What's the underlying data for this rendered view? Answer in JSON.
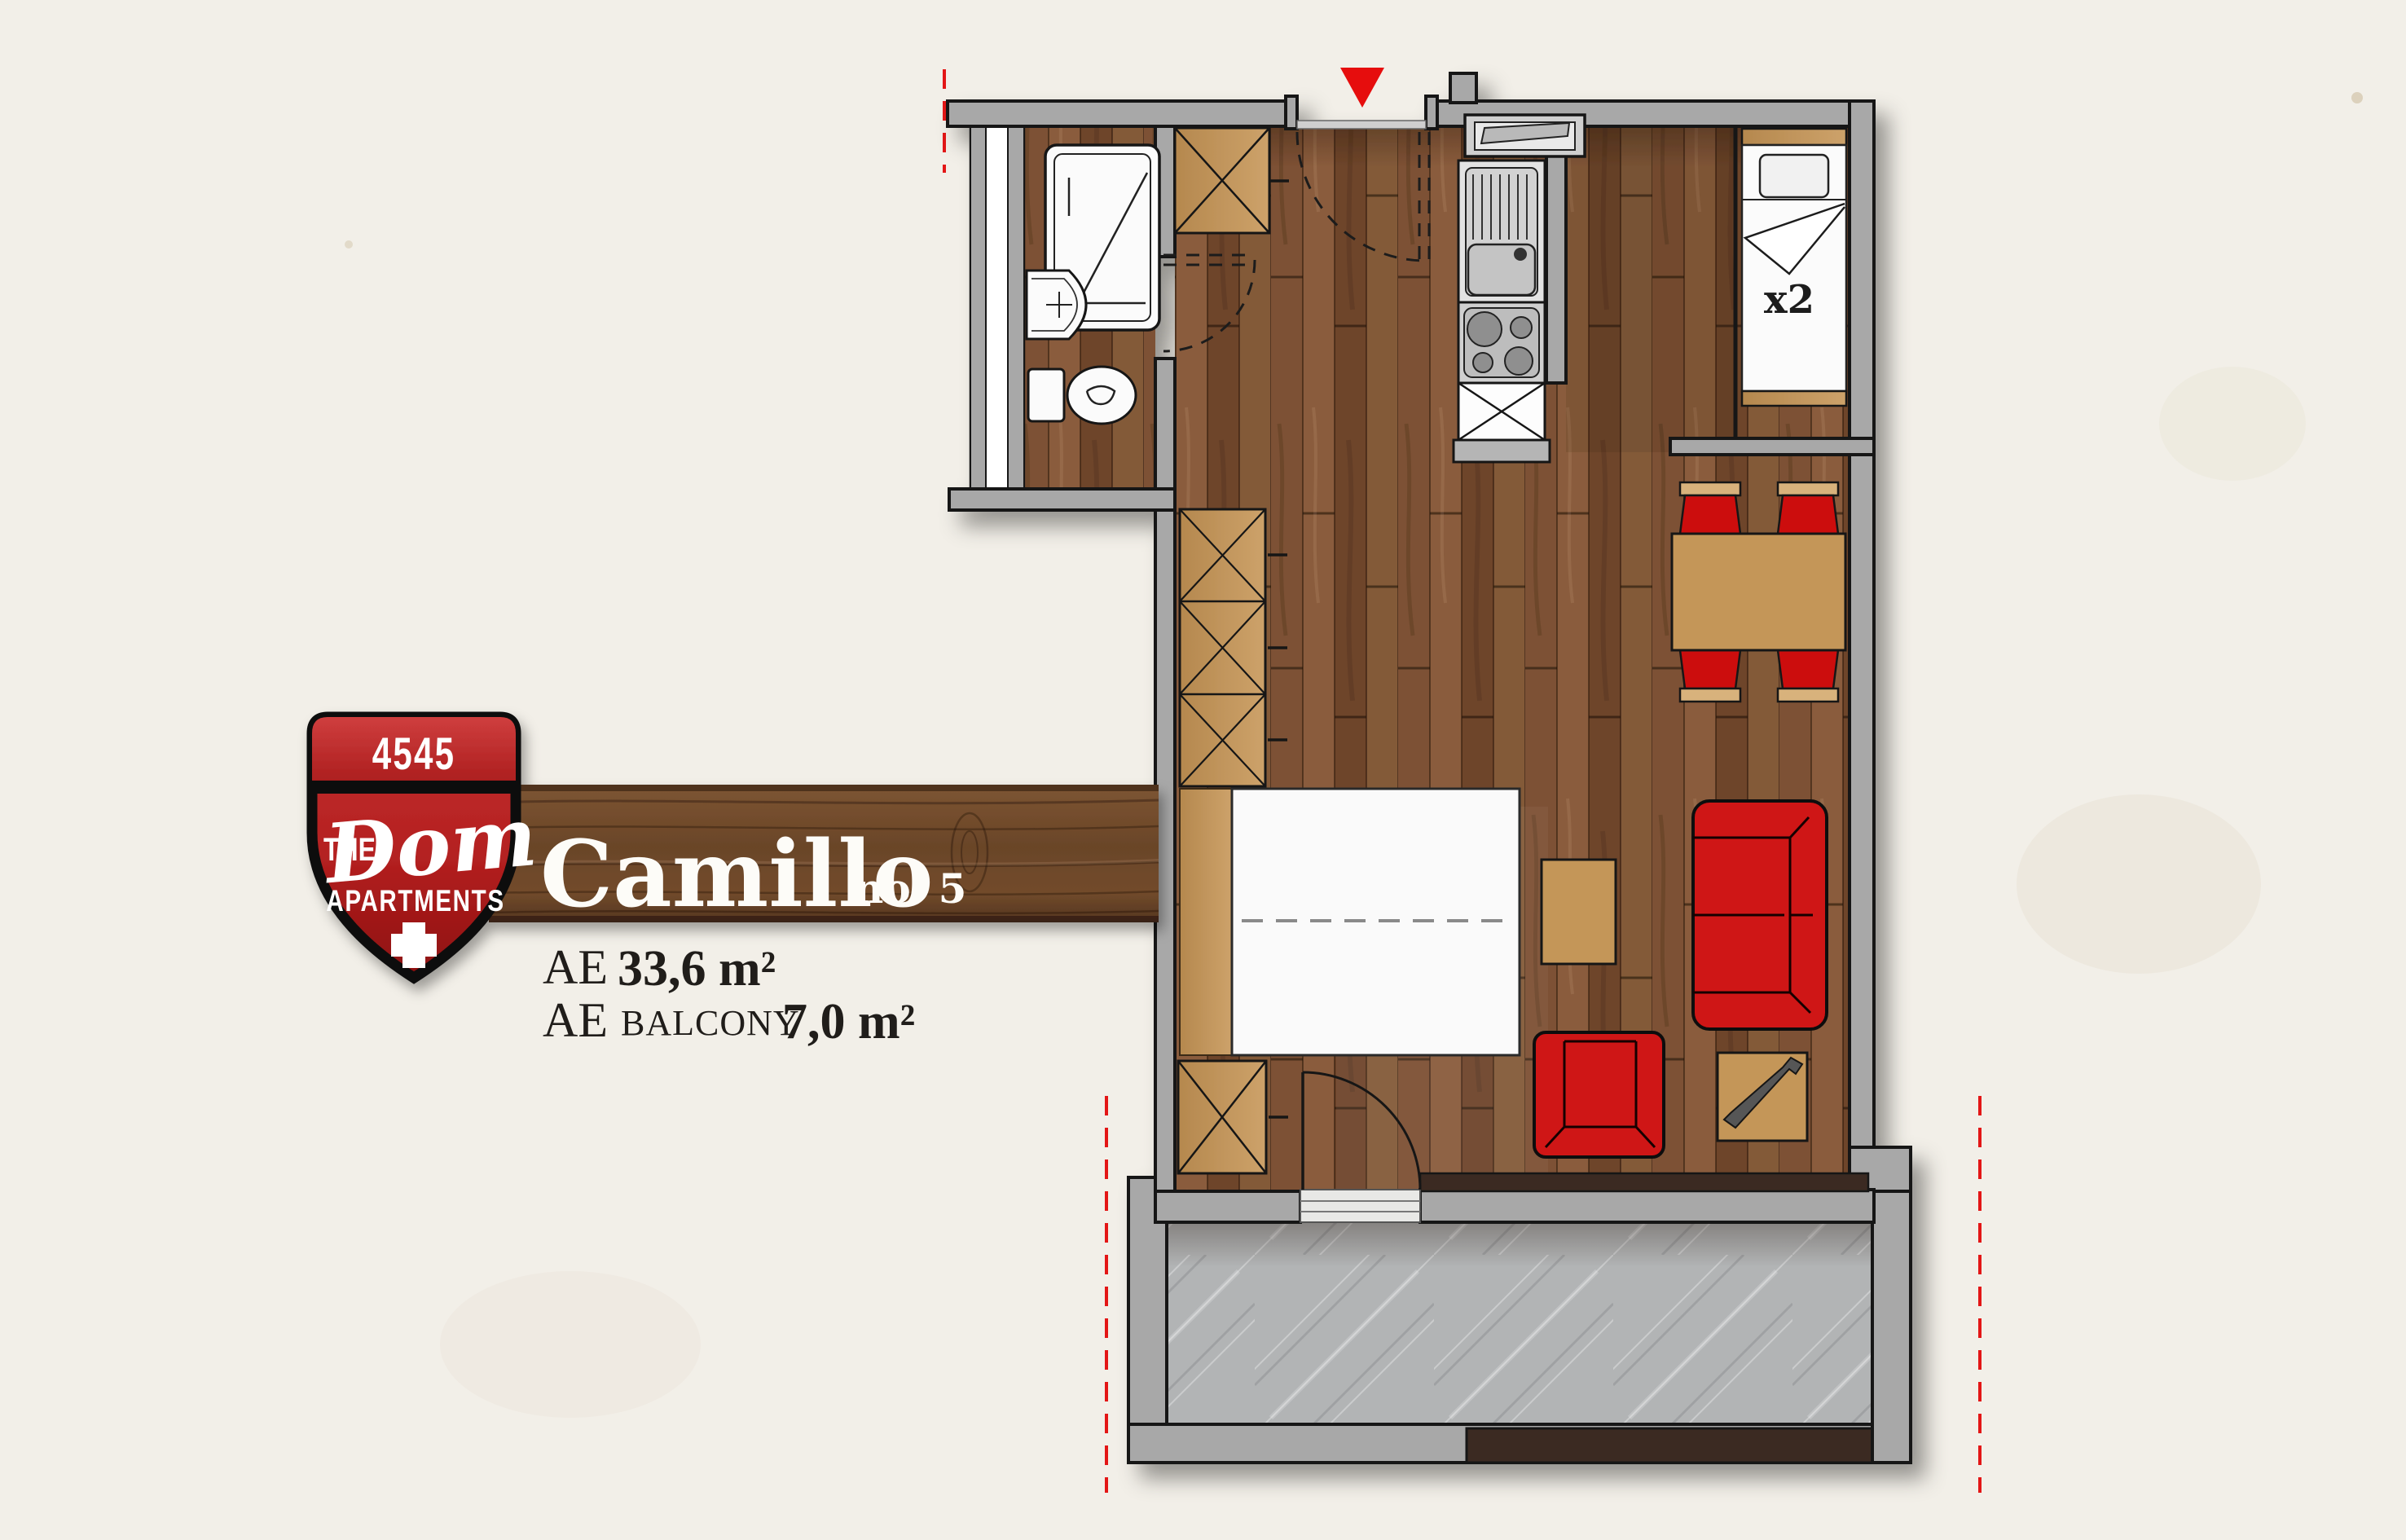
{
  "badge": {
    "number": "4545",
    "the": "THE",
    "name": "Dom",
    "subtitle": "APARTMENTS",
    "cross_icon": "swiss-cross"
  },
  "banner": {
    "title": "Camillo",
    "unit": "no. 5"
  },
  "areas": {
    "l1_label": "AE",
    "l1_value": "33,6 m²",
    "l2_label": "AE",
    "l2_sub": "BALCONY",
    "l2_value": "7,0 m²"
  },
  "plan": {
    "bed_label": "x2",
    "entrance_marker": "red-triangle"
  },
  "colors": {
    "paper": "#f2efe8",
    "wall_gray": "#a8a8a8",
    "wood_brown": "#7b4e31",
    "furniture_tan": "#c49659",
    "accent_red": "#cf1414",
    "shield_red": "#b32020",
    "concrete_gray": "#b2b4b5",
    "threshold_brown": "#3a2c20",
    "guide_red_dash": "#e31616"
  }
}
